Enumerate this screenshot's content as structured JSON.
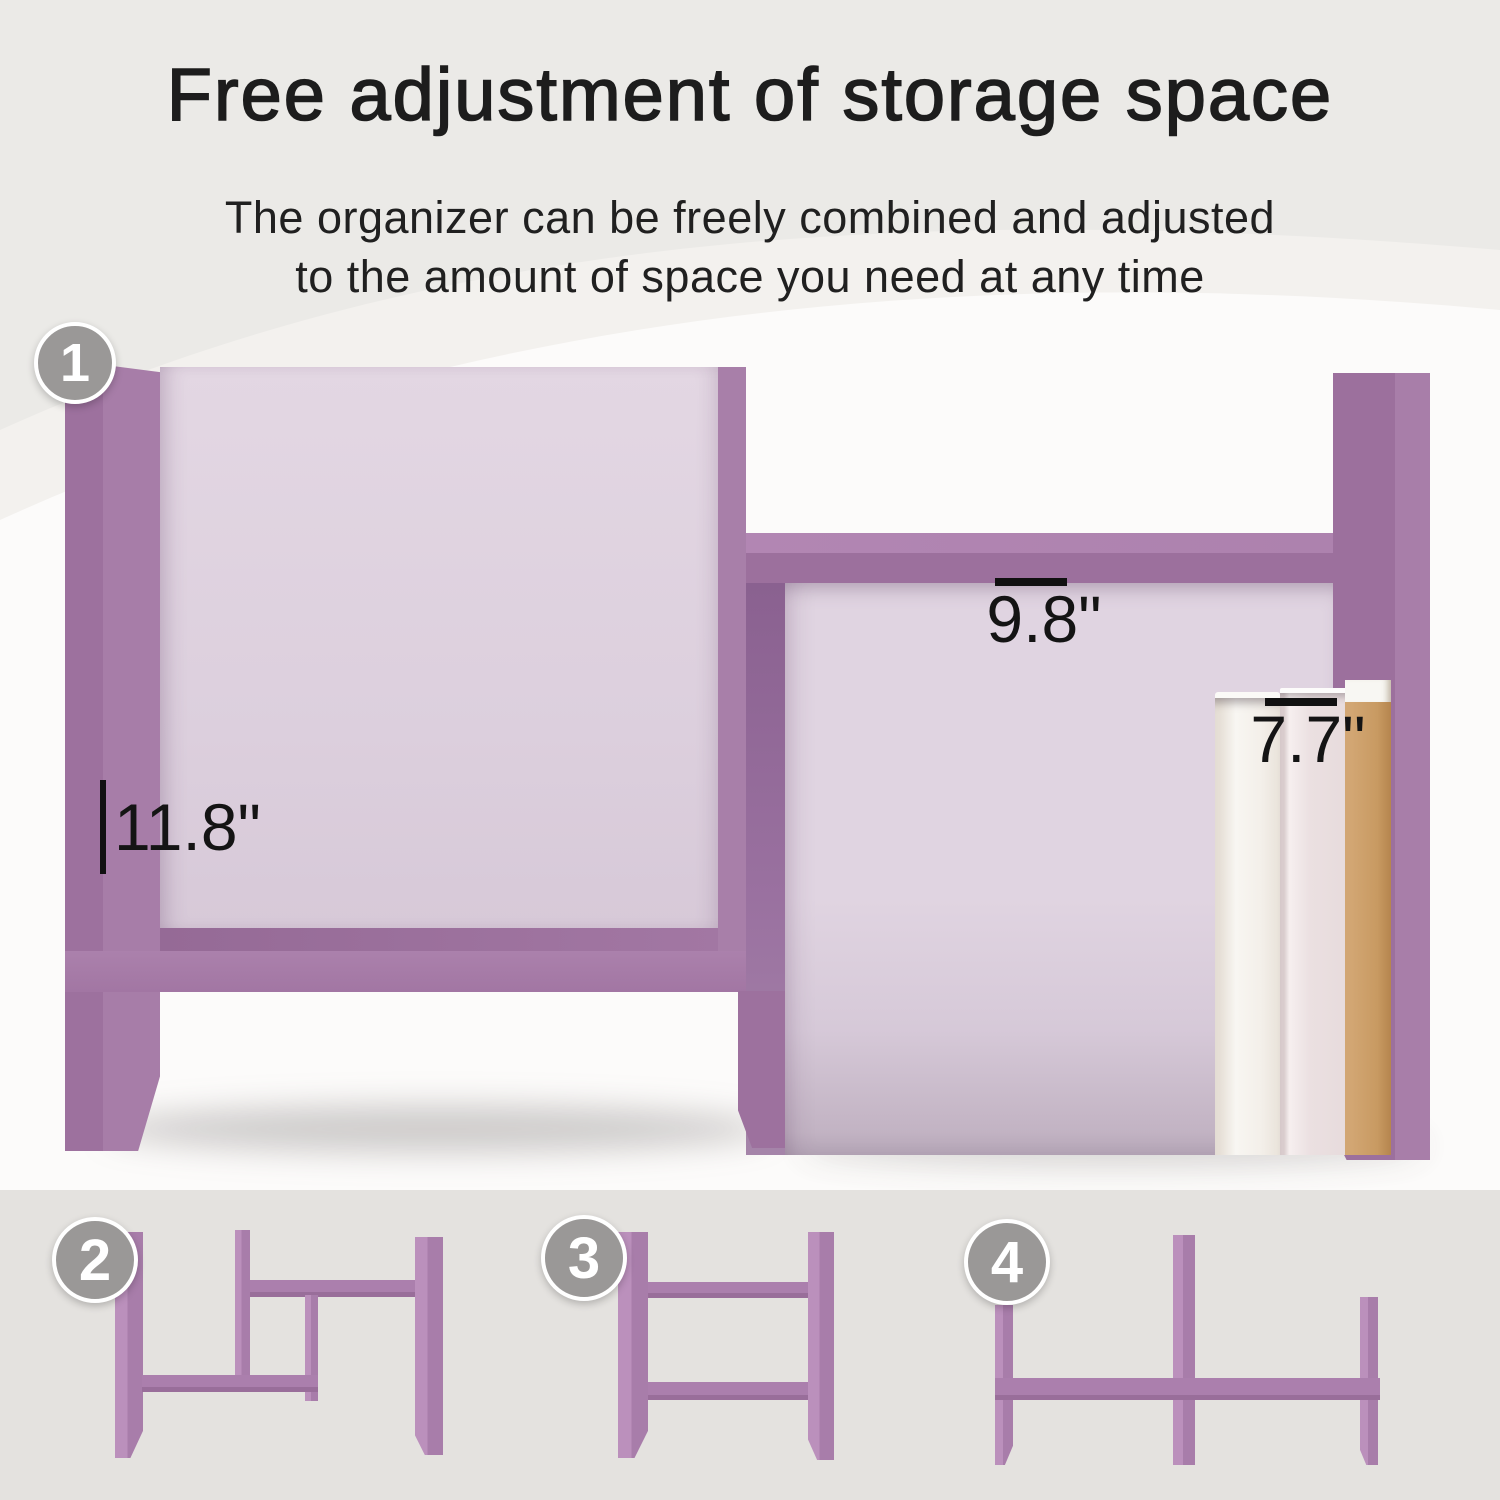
{
  "title": "Free adjustment of storage space",
  "subtitle": {
    "line1": "The organizer can be freely combined and adjusted",
    "line2": "to the amount of space you need at any time"
  },
  "badges": {
    "b1": "1",
    "b2": "2",
    "b3": "3",
    "b4": "4"
  },
  "dimensions": {
    "width": "11.8\"",
    "height": "9.8\"",
    "book_height": "7.7\""
  },
  "colors": {
    "purple_face": "#a77fa8",
    "purple_dark": "#9c709d",
    "purple_side_shadow": "#8a6190",
    "lavender_interior": "#ddd0de",
    "footer_gray": "#e4e2df",
    "badge_gray": "#9a9897",
    "book_tan": "#c89a62",
    "wall_white": "#fcfbfa",
    "annotation_black": "#141414"
  }
}
